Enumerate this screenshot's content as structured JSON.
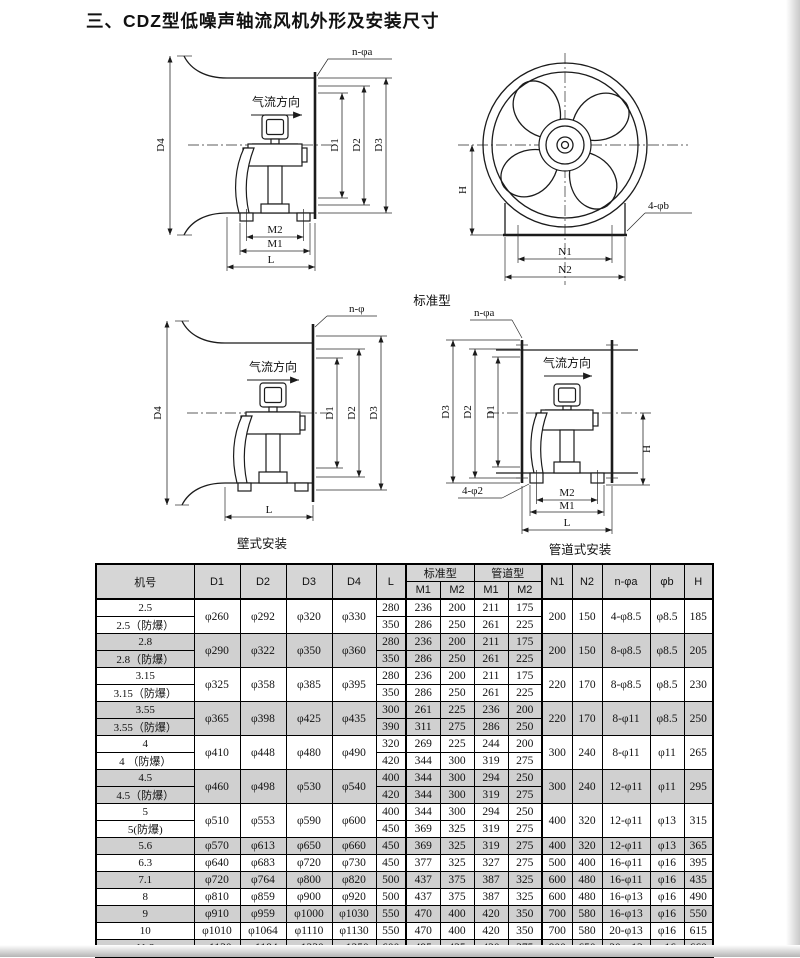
{
  "title": "三、CDZ型低噪声轴流风机外形及安装尺寸",
  "captions": {
    "standard": "标准型",
    "wall": "壁式安装",
    "duct": "管道式安装"
  },
  "diagrams": {
    "standard_side": {
      "labels": {
        "nphia": "n-φa",
        "airflow": "气流方向",
        "d4": "D4",
        "d1": "D1",
        "d2": "D2",
        "d3": "D3",
        "m2": "M2",
        "m1": "M1",
        "l": "L"
      }
    },
    "standard_front": {
      "labels": {
        "h": "H",
        "phib4": "4-φb",
        "n1": "N1",
        "n2": "N2"
      }
    },
    "wall": {
      "labels": {
        "nphi": "n-φ",
        "airflow": "气流方向",
        "d4": "D4",
        "d1": "D1",
        "d2": "D2",
        "d3": "D3",
        "l": "L"
      }
    },
    "duct": {
      "labels": {
        "nphia": "n-φa",
        "airflow": "气流方向",
        "d3": "D3",
        "d2": "D2",
        "d1": "D1",
        "h": "H",
        "phi2_4": "4-φ2",
        "m2": "M2",
        "m1": "M1",
        "l": "L"
      }
    }
  },
  "table": {
    "headers": {
      "model": "机号",
      "d1": "D1",
      "d2": "D2",
      "d3": "D3",
      "d4": "D4",
      "l": "L",
      "std": "标准型",
      "duct": "管道型",
      "m1": "M1",
      "m2": "M2",
      "n1": "N1",
      "n2": "N2",
      "nphia": "n-φa",
      "phib": "φb",
      "h": "H"
    },
    "rows": [
      {
        "name": "2.5",
        "name2": "2.5（防爆）",
        "d": [
          "φ260",
          "φ292",
          "φ320",
          "φ330"
        ],
        "l": [
          "280",
          "350"
        ],
        "m": [
          [
            "236",
            "200",
            "211",
            "175"
          ],
          [
            "286",
            "250",
            "261",
            "225"
          ]
        ],
        "n1": "200",
        "n2": "150",
        "na": "4-φ8.5",
        "b": "φ8.5",
        "h": "185",
        "shaded": false
      },
      {
        "name": "2.8",
        "name2": "2.8（防爆）",
        "d": [
          "φ290",
          "φ322",
          "φ350",
          "φ360"
        ],
        "l": [
          "280",
          "350"
        ],
        "m": [
          [
            "236",
            "200",
            "211",
            "175"
          ],
          [
            "286",
            "250",
            "261",
            "225"
          ]
        ],
        "n1": "200",
        "n2": "150",
        "na": "8-φ8.5",
        "b": "φ8.5",
        "h": "205",
        "shaded": true
      },
      {
        "name": "3.15",
        "name2": "3.15（防爆）",
        "d": [
          "φ325",
          "φ358",
          "φ385",
          "φ395"
        ],
        "l": [
          "280",
          "350"
        ],
        "m": [
          [
            "236",
            "200",
            "211",
            "175"
          ],
          [
            "286",
            "250",
            "261",
            "225"
          ]
        ],
        "n1": "220",
        "n2": "170",
        "na": "8-φ8.5",
        "b": "φ8.5",
        "h": "230",
        "shaded": false
      },
      {
        "name": "3.55",
        "name2": "3.55（防爆）",
        "d": [
          "φ365",
          "φ398",
          "φ425",
          "φ435"
        ],
        "l": [
          "300",
          "390"
        ],
        "m": [
          [
            "261",
            "225",
            "236",
            "200"
          ],
          [
            "311",
            "275",
            "286",
            "250"
          ]
        ],
        "n1": "220",
        "n2": "170",
        "na": "8-φ11",
        "b": "φ8.5",
        "h": "250",
        "shaded": true
      },
      {
        "name": "4",
        "name2": "4 （防爆）",
        "d": [
          "φ410",
          "φ448",
          "φ480",
          "φ490"
        ],
        "l": [
          "320",
          "420"
        ],
        "m": [
          [
            "269",
            "225",
            "244",
            "200"
          ],
          [
            "344",
            "300",
            "319",
            "275"
          ]
        ],
        "n1": "300",
        "n2": "240",
        "na": "8-φ11",
        "b": "φ11",
        "h": "265",
        "shaded": false
      },
      {
        "name": "4.5",
        "name2": "4.5（防爆）",
        "d": [
          "φ460",
          "φ498",
          "φ530",
          "φ540"
        ],
        "l": [
          "400",
          "420"
        ],
        "m": [
          [
            "344",
            "300",
            "294",
            "250"
          ],
          [
            "344",
            "300",
            "319",
            "275"
          ]
        ],
        "n1": "300",
        "n2": "240",
        "na": "12-φ11",
        "b": "φ11",
        "h": "295",
        "shaded": true
      },
      {
        "name": "5",
        "name2": "5(防爆)",
        "d": [
          "φ510",
          "φ553",
          "φ590",
          "φ600"
        ],
        "l": [
          "400",
          "450"
        ],
        "m": [
          [
            "344",
            "300",
            "294",
            "250"
          ],
          [
            "369",
            "325",
            "319",
            "275"
          ]
        ],
        "n1": "400",
        "n2": "320",
        "na": "12-φ11",
        "b": "φ13",
        "h": "315",
        "shaded": false
      },
      {
        "name": "5.6",
        "d": [
          "φ570",
          "φ613",
          "φ650",
          "φ660"
        ],
        "l": [
          "450"
        ],
        "m": [
          [
            "369",
            "325",
            "319",
            "275"
          ]
        ],
        "n1": "400",
        "n2": "320",
        "na": "12-φ11",
        "b": "φ13",
        "h": "365",
        "shaded": true
      },
      {
        "name": "6.3",
        "d": [
          "φ640",
          "φ683",
          "φ720",
          "φ730"
        ],
        "l": [
          "450"
        ],
        "m": [
          [
            "377",
            "325",
            "327",
            "275"
          ]
        ],
        "n1": "500",
        "n2": "400",
        "na": "16-φ11",
        "b": "φ16",
        "h": "395",
        "shaded": false
      },
      {
        "name": "7.1",
        "d": [
          "φ720",
          "φ764",
          "φ800",
          "φ820"
        ],
        "l": [
          "500"
        ],
        "m": [
          [
            "437",
            "375",
            "387",
            "325"
          ]
        ],
        "n1": "600",
        "n2": "480",
        "na": "16-φ11",
        "b": "φ16",
        "h": "435",
        "shaded": true
      },
      {
        "name": "8",
        "d": [
          "φ810",
          "φ859",
          "φ900",
          "φ920"
        ],
        "l": [
          "500"
        ],
        "m": [
          [
            "437",
            "375",
            "387",
            "325"
          ]
        ],
        "n1": "600",
        "n2": "480",
        "na": "16-φ13",
        "b": "φ16",
        "h": "490",
        "shaded": false
      },
      {
        "name": "9",
        "d": [
          "φ910",
          "φ959",
          "φ1000",
          "φ1030"
        ],
        "l": [
          "550"
        ],
        "m": [
          [
            "470",
            "400",
            "420",
            "350"
          ]
        ],
        "n1": "700",
        "n2": "580",
        "na": "16-φ13",
        "b": "φ16",
        "h": "550",
        "shaded": true
      },
      {
        "name": "10",
        "d": [
          "φ1010",
          "φ1064",
          "φ1110",
          "φ1130"
        ],
        "l": [
          "550"
        ],
        "m": [
          [
            "470",
            "400",
            "420",
            "350"
          ]
        ],
        "n1": "700",
        "n2": "580",
        "na": "20-φ13",
        "b": "φ16",
        "h": "615",
        "shaded": false
      },
      {
        "name": "11.2",
        "d": [
          "φ1130",
          "φ1184",
          "φ1230",
          "φ1250"
        ],
        "l": [
          "600"
        ],
        "m": [
          [
            "495",
            "425",
            "420",
            "375"
          ]
        ],
        "n1": "800",
        "n2": "650",
        "na": "20-φ13",
        "b": "φ16",
        "h": "660",
        "shaded": true
      }
    ]
  }
}
